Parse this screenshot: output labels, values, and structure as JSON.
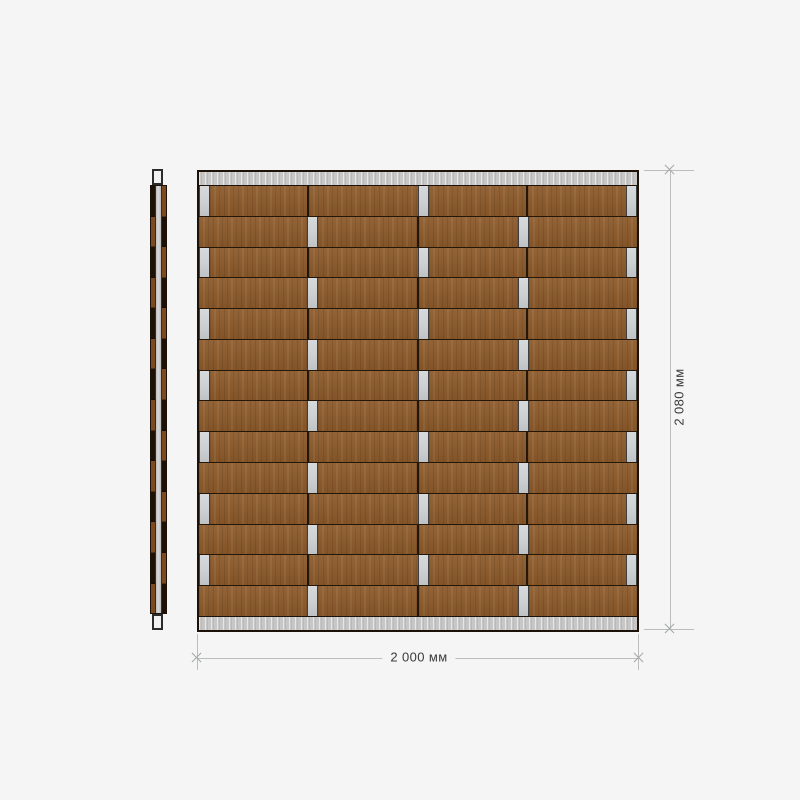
{
  "canvas": {
    "background": "#f5f5f5"
  },
  "panel": {
    "front_view": {
      "rows": 14,
      "columns": 4,
      "row_types": [
        "A",
        "B",
        "A",
        "B",
        "A",
        "B",
        "A",
        "B",
        "A",
        "B",
        "A",
        "B",
        "A",
        "B"
      ],
      "segments": {
        "A": [
          [
            "gap",
            11
          ],
          [
            "wood",
            99
          ],
          [
            "woodj",
            111
          ],
          [
            "gap",
            11
          ],
          [
            "wood",
            99
          ],
          [
            "woodj",
            100
          ],
          [
            "gap",
            11
          ]
        ],
        "B": [
          [
            "wood",
            110
          ],
          [
            "gap",
            11
          ],
          [
            "wood",
            100
          ],
          [
            "woodj",
            100
          ],
          [
            "gap",
            11
          ],
          [
            "wood",
            110
          ]
        ]
      }
    },
    "side_view": {
      "segments": 14
    }
  },
  "dimensions": {
    "width_label": "2 000 мм",
    "height_label": "2 080 мм"
  },
  "colors": {
    "bg": "#f5f5f5",
    "wood": "#8c5a2b",
    "wood-dark-line": "#241708",
    "rail": "#c7c7c7",
    "gap-metal": "#ccd0d2",
    "outline": "#1c1209",
    "dim-line": "#bdbdbd",
    "dim-text": "#3a3a3a",
    "sv-wood": "#7d4a20",
    "sv-dark": "#1d1105",
    "cap-fill": "#f1f1f1"
  }
}
